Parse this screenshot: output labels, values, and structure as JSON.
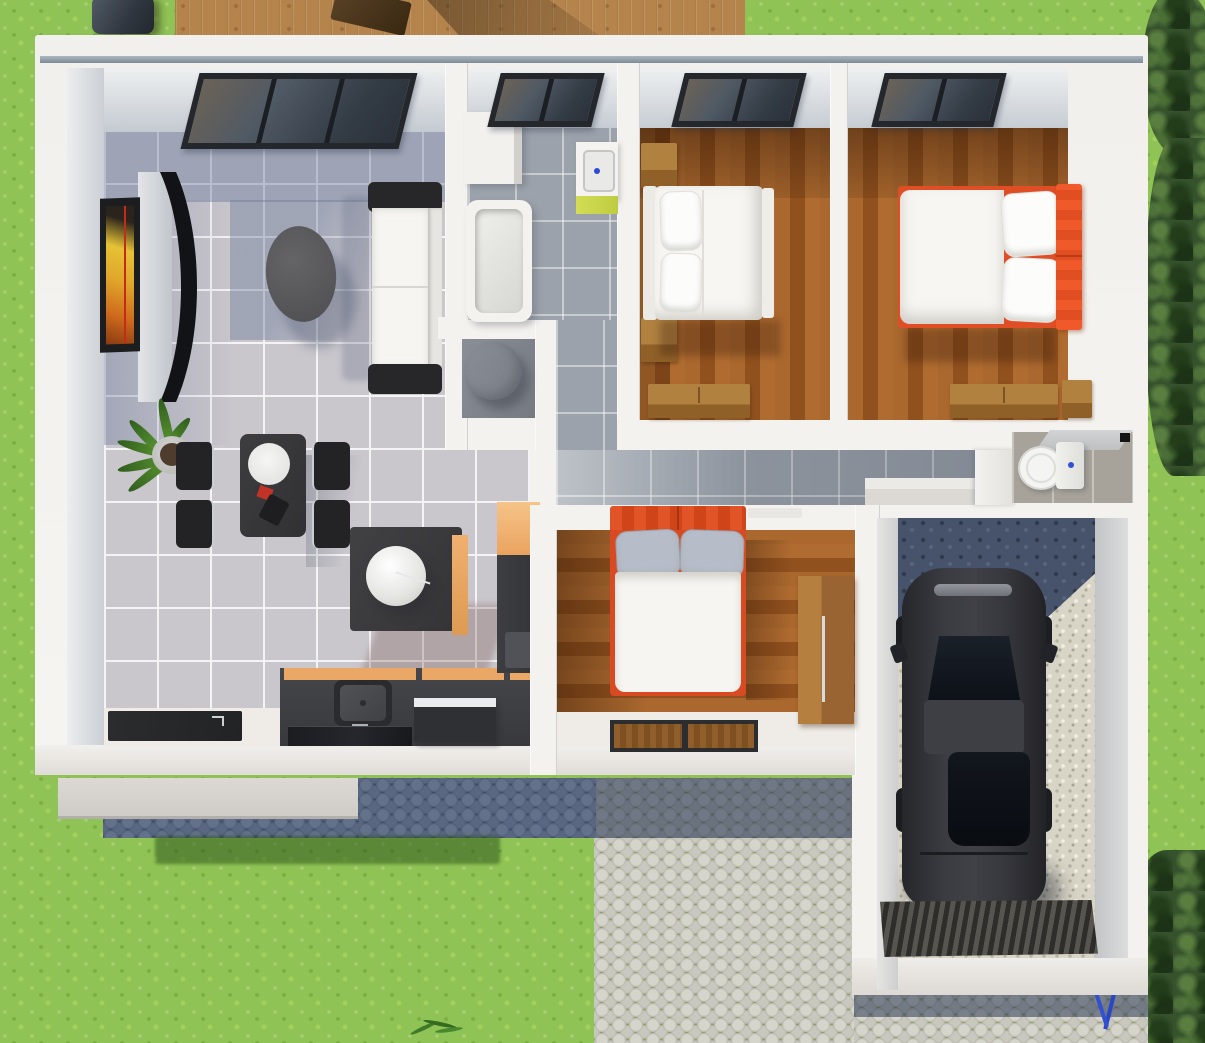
{
  "scene": {
    "title": "Top-down 3D rendering of a single-storey house floor plan with attached garage, lawn, wooden deck and cobblestone driveway",
    "view": "top-down 3D render",
    "visible_text": "none"
  },
  "palette": {
    "grass": "#90c355",
    "deck_wood": "#b5834c",
    "wall_white": "#f4f2ee",
    "wall_cap_bluegray": "#8fa0ac",
    "tile_light": "#c9c6cc",
    "tile_gray": "#9ba2ab",
    "bedroom_wood": "#a05f27",
    "accent_orange_bed": "#e04e25",
    "kitchen_orange": "#eba766",
    "lime_accent": "#cdd84d",
    "cobble_light": "#d2d1c8",
    "cobble_shadow_blue": "#5e6d85",
    "gravel": "#d8d4c6",
    "car_black": "#34353a",
    "interior_shadow_blue": "rgba(100,116,150,0.4)"
  },
  "rooms": {
    "living": {
      "label": "Living / dining / kitchen",
      "floor": "light gray tile",
      "furniture": [
        "curved wall TV",
        "TV wall panel",
        "picture frame with yellow-orange art",
        "white sofa with dark armrests",
        "dark oval coffee table",
        "potted plant",
        "dark dining table with 4 chairs",
        "white plate",
        "kitchen island with white decor ball",
        "kitchen counter with sink and faucet",
        "dark glass cooktop",
        "appliance with white top",
        "orange cabinet",
        "dark cabinet column",
        "dark entrance mat"
      ]
    },
    "bathroom": {
      "label": "Bathroom",
      "floor": "gray tile",
      "furniture": [
        "bathtub",
        "washbasin with blue tap dot and lime cabinet",
        "white storage cabinet",
        "window"
      ]
    },
    "laundry": {
      "label": "Laundry nook",
      "floor": "dark gray",
      "furniture": [
        "round-top washing machine"
      ]
    },
    "hallway": {
      "label": "Hallway",
      "floor": "gray tile",
      "furniture": [
        "white end counter",
        "side counter"
      ]
    },
    "bedroom1": {
      "label": "Bedroom 1",
      "floor": "wood planks",
      "furniture": [
        "double bed with white linen and two pillows",
        "nightstand upper",
        "nightstand lower",
        "dresser",
        "window"
      ]
    },
    "bedroom2": {
      "label": "Bedroom 2",
      "floor": "wood planks",
      "furniture": [
        "double bed with orange frame and orange headboard",
        "two white pillows",
        "dresser",
        "nightstand",
        "window"
      ]
    },
    "bedroom3": {
      "label": "Bedroom 3",
      "floor": "wood planks",
      "furniture": [
        "double bed with orange frame and headboard",
        "two gray pillows",
        "wooden wardrobe with metal handle",
        "two dark-framed door mats",
        "door leaf"
      ]
    },
    "wc": {
      "label": "WC",
      "floor": "beige-gray tile",
      "furniture": [
        "toilet with blue button",
        "corner shelf",
        "black wall vent"
      ]
    },
    "garage": {
      "label": "Garage",
      "floor": "gravel",
      "furniture": [
        "black car seen from above",
        "corrugated entry ramp"
      ]
    }
  },
  "exterior": {
    "label": "Yard",
    "features": [
      "lawn",
      "wooden deck strip",
      "dark barbecue grill",
      "dark planter box on deck",
      "deck shadow",
      "gray porch slab",
      "shadowed cobblestone strip along house",
      "house shadow on grass",
      "light cobblestone driveway",
      "cobblestone apron below garage",
      "tree and shrub clusters on the right",
      "small plant sprig at bottom",
      "small blue garden object near garage"
    ]
  }
}
